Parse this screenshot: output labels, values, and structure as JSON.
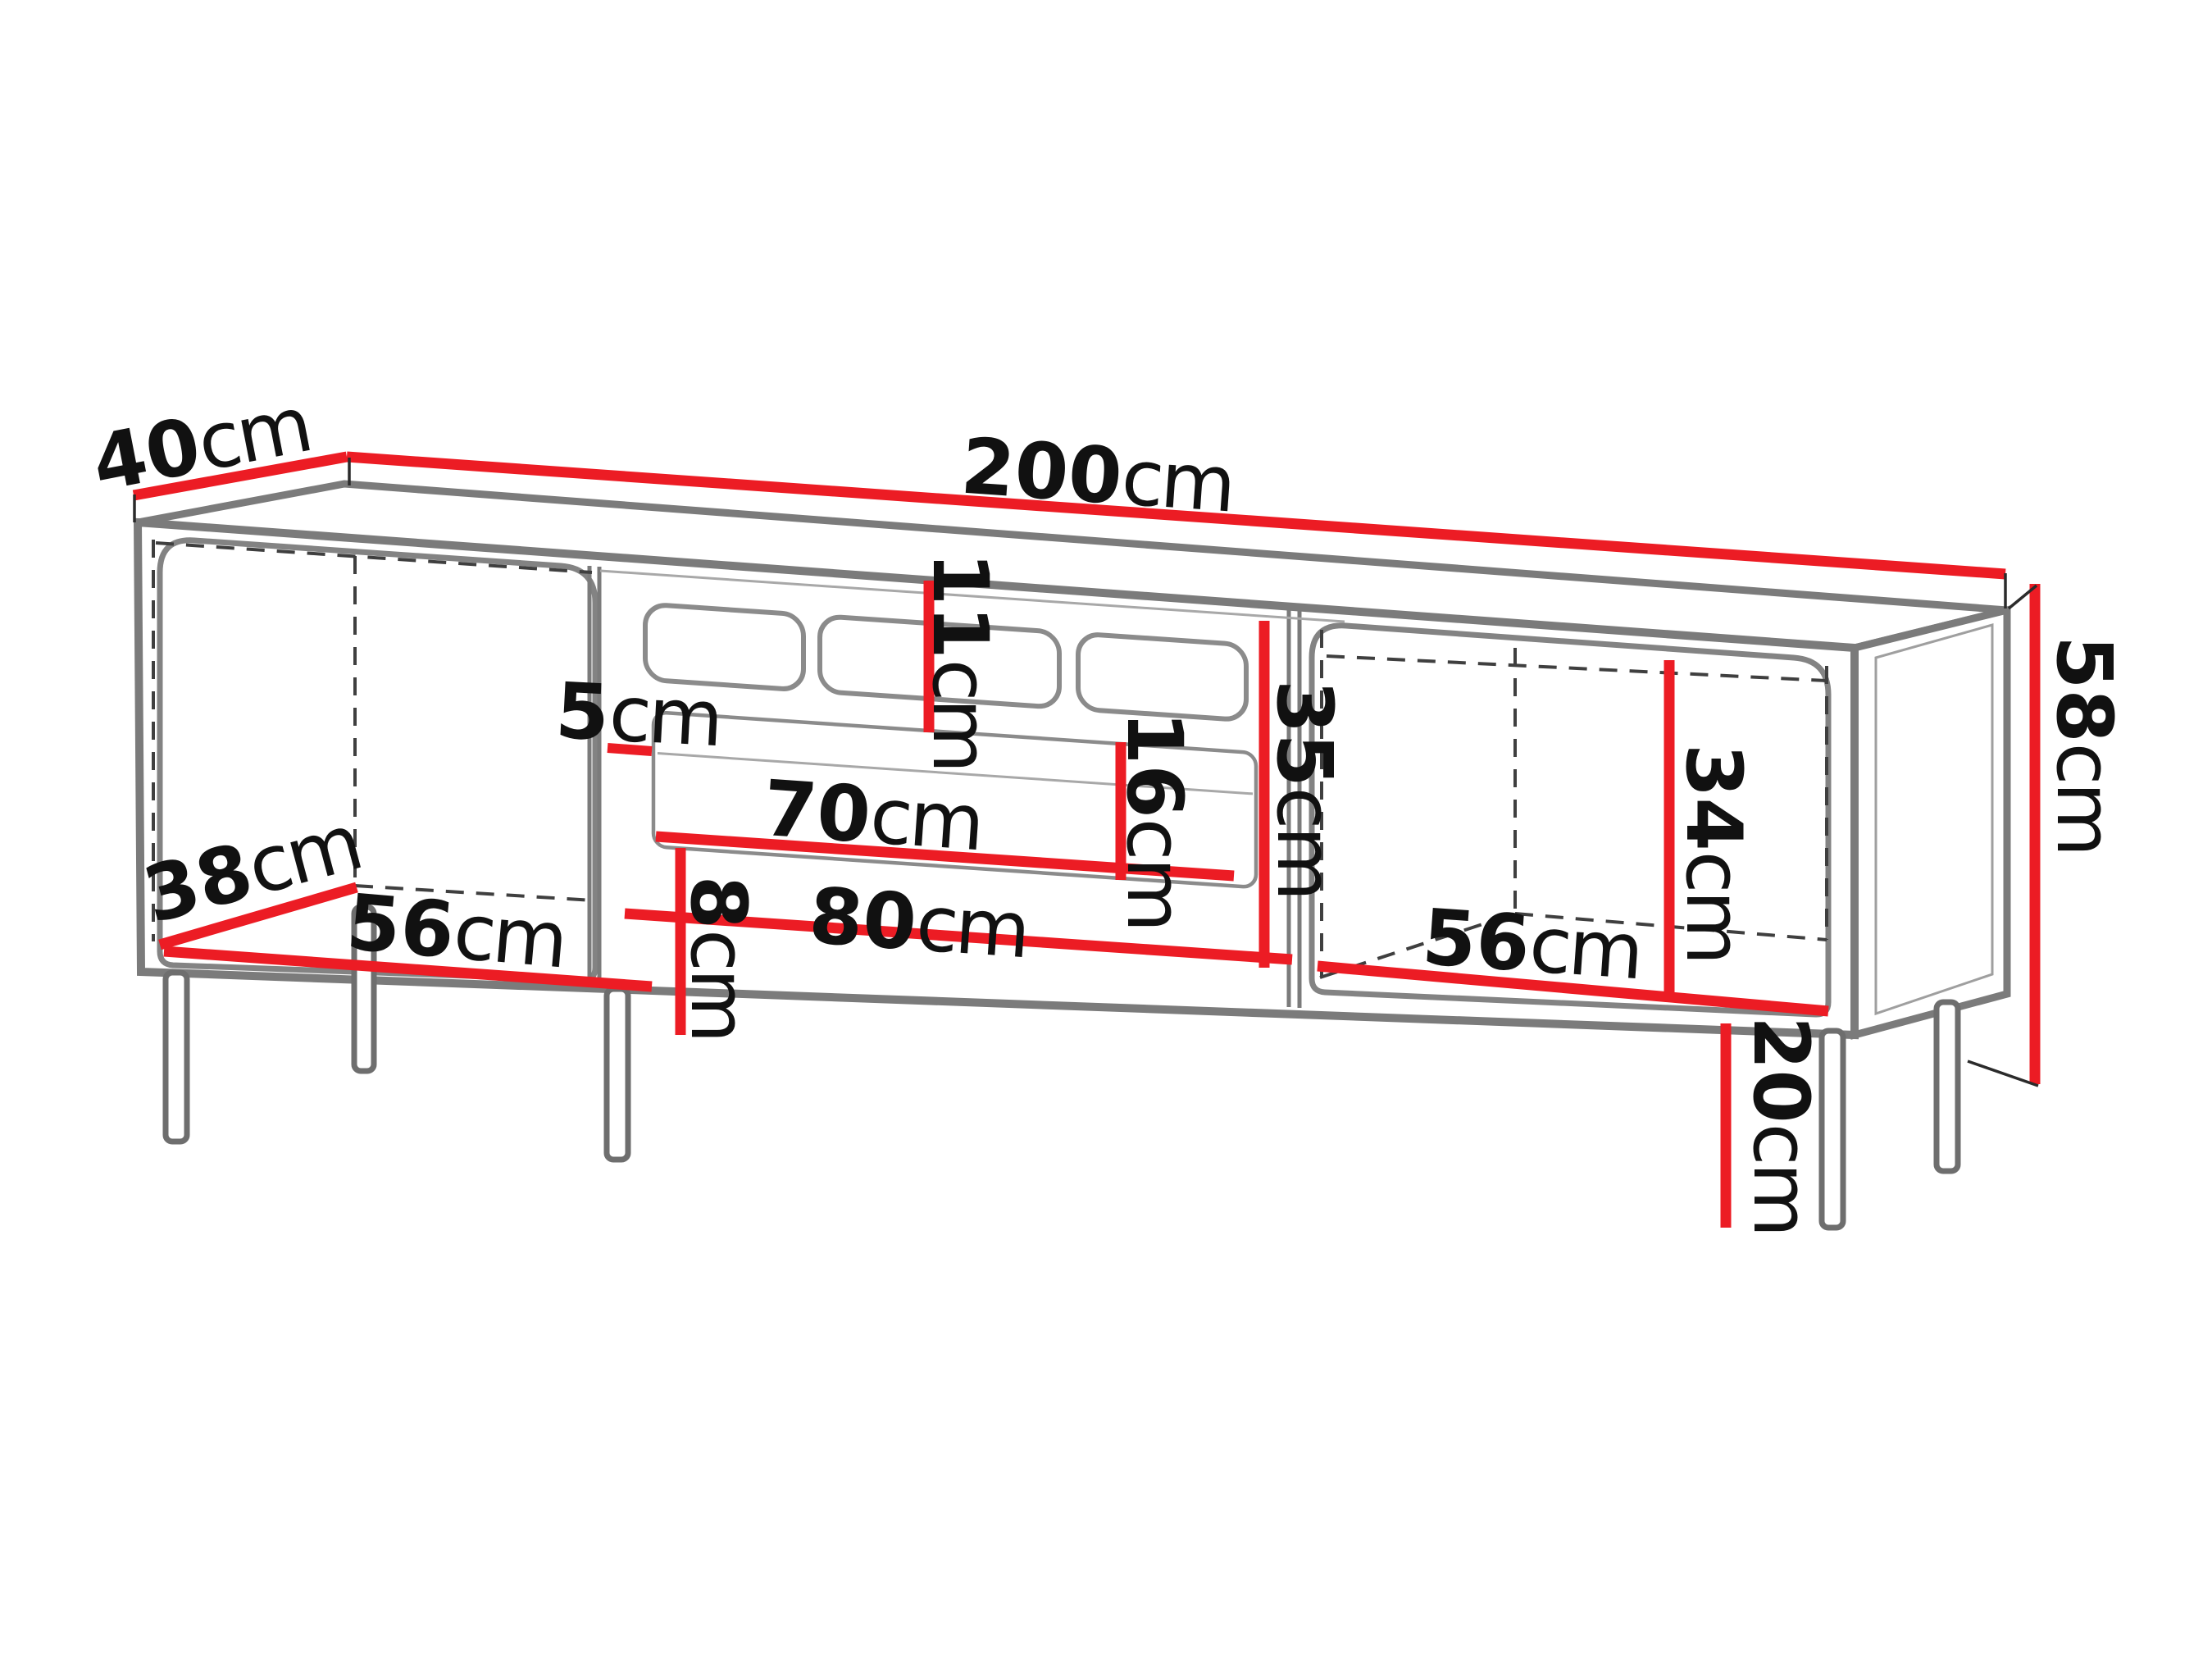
{
  "diagram": {
    "kind": "furniture-dimension-drawing",
    "subject": "TV stand cabinet with three sections, drawer, vent slots and legs",
    "unit": "cm",
    "colors": {
      "dimension": "#ec1c24",
      "outline": "#7b7b7b",
      "text": "#111111",
      "dashed": "#3f3f3f",
      "background": "#ffffff"
    },
    "labels": {
      "top_depth": {
        "value": "40",
        "unit": "cm"
      },
      "top_width": {
        "value": "200",
        "unit": "cm"
      },
      "total_height": {
        "value": "58",
        "unit": "cm"
      },
      "leg_height": {
        "value": "20",
        "unit": "cm"
      },
      "left_interior_depth": {
        "value": "38",
        "unit": "cm"
      },
      "left_interior_width": {
        "value": "56",
        "unit": "cm"
      },
      "divider_offset": {
        "value": "5",
        "unit": "cm"
      },
      "vent_strip_height": {
        "value": "11",
        "unit": "cm"
      },
      "drawer_front_height": {
        "value": "16",
        "unit": "cm"
      },
      "middle_interior_height": {
        "value": "35",
        "unit": "cm"
      },
      "drawer_width": {
        "value": "70",
        "unit": "cm"
      },
      "middle_interior_width": {
        "value": "80",
        "unit": "cm"
      },
      "right_interior_height": {
        "value": "34",
        "unit": "cm"
      },
      "right_interior_width": {
        "value": "56",
        "unit": "cm"
      },
      "bottom_rail_height": {
        "value": "8",
        "unit": "cm"
      }
    }
  }
}
